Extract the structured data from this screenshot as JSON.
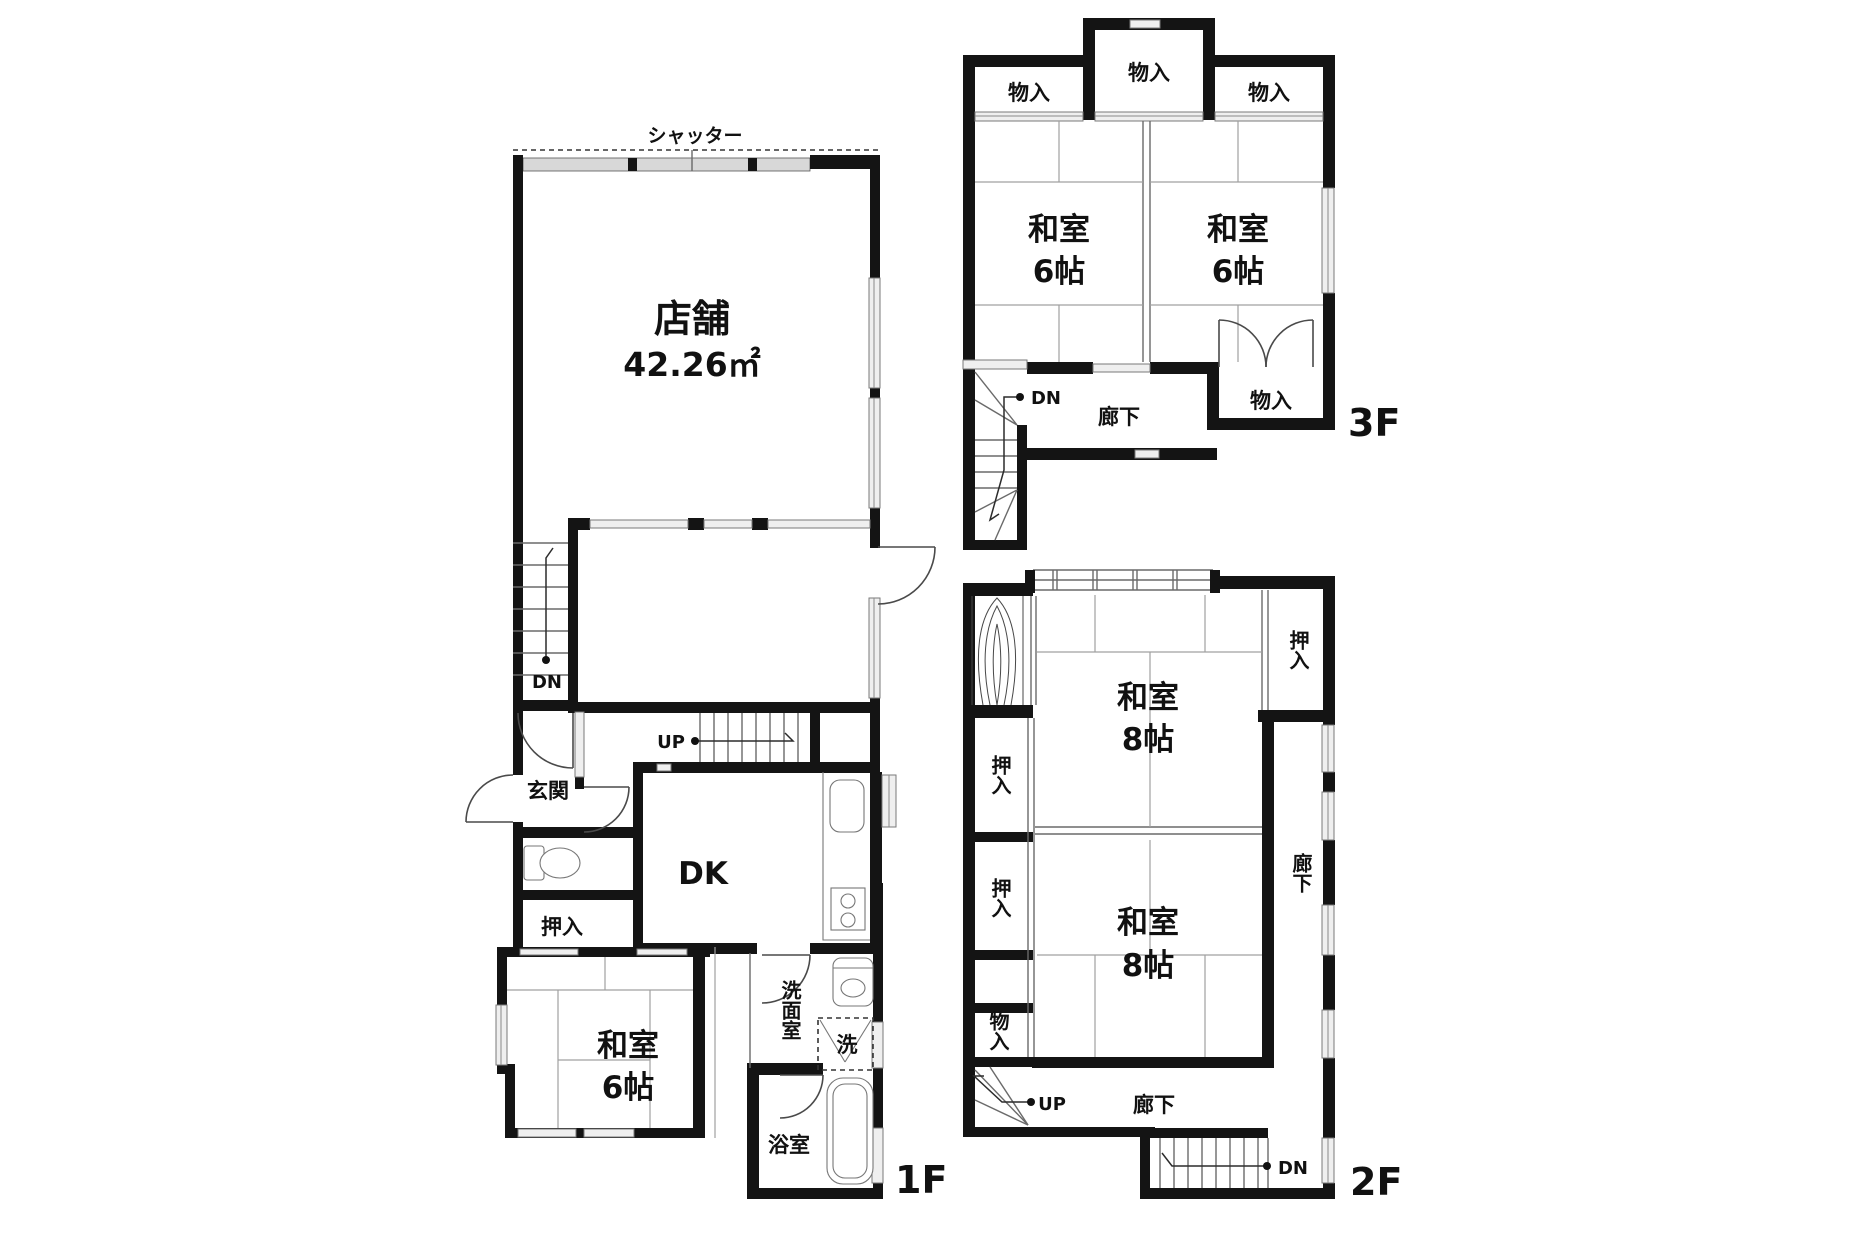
{
  "common": {
    "up": "UP",
    "dn": "DN",
    "corridor": "廊下",
    "closet": "押入",
    "storage": "物入",
    "japanese_room": "和室",
    "mats_6": "6帖",
    "mats_8": "8帖"
  },
  "floor1": {
    "label": "1F",
    "shutter": "シャッター",
    "shop": "店舗",
    "shop_area": "42.26㎡",
    "entrance": "玄関",
    "dk": "DK",
    "washroom": "洗面室",
    "laundry": "洗",
    "bathroom": "浴室"
  },
  "floor2": {
    "label": "2F"
  },
  "floor3": {
    "label": "3F"
  }
}
